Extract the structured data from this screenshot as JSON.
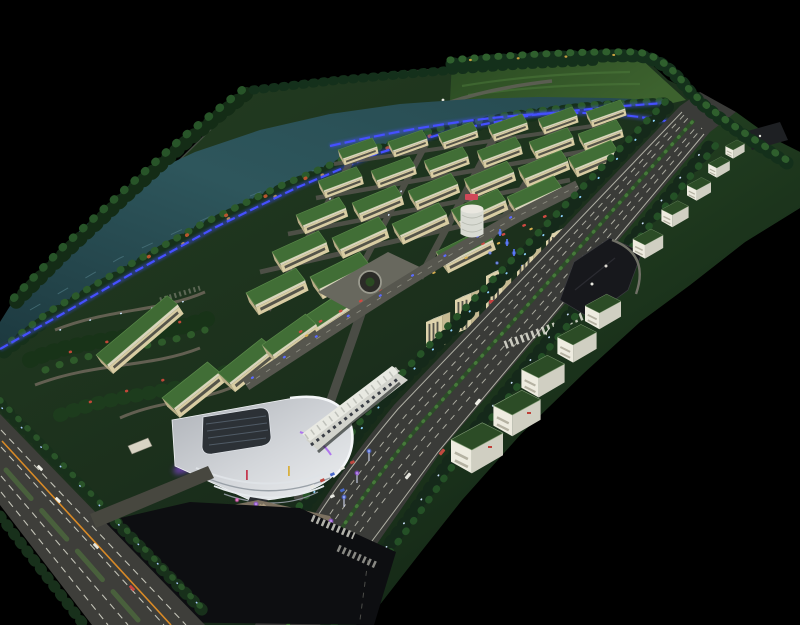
{
  "meta": {
    "type": "photograph",
    "subject": "Illuminated architectural scale model of an industrial park district, elevated oblique view on a black backdrop",
    "canvas": {
      "width": 800,
      "height": 625
    },
    "visible_text": []
  },
  "palette": {
    "background": "#000000",
    "site_green": "#1d331e",
    "lawn_green": "#3d622e",
    "water_teal": "#2e565c",
    "foliage_dark": "#15291a",
    "foliage_light": "#2c5a2b",
    "roof_green": "#416e36",
    "wall_cream": "#d8cca2",
    "tower_cream": "#ded3ac",
    "slab_white": "#e9e7dc",
    "asphalt": "#3a3b38",
    "asphalt_dark": "#0d0e11",
    "road_internal": "#54544c",
    "lane_dash": "#dadacb",
    "led_blue": "#4550ff",
    "accent_purple": "#a55cf0",
    "glow_pink": "#ff5fd0",
    "plaza_tan": "#7c7160",
    "centerline_orange": "#d98a26",
    "sign_red": "#c84040",
    "sign_pink": "#d04858",
    "cube_wall": "#eeece0",
    "cube_roof": "#2c4c26",
    "boat_white": "#e9e9e2"
  },
  "scene": {
    "board": {
      "label": "model board",
      "description": "rectangular site in two-point perspective, long axis receding to the upper right"
    },
    "river": {
      "label": "tree-lined canal with blue LED bank lighting",
      "boats": 6
    },
    "lawn": {
      "label": "open lawn field with perimeter tree row"
    },
    "warehouse_district": {
      "label": "grid of cream warehouses with green roofs",
      "blocks": 31,
      "rows": 7
    },
    "central_plaza": {
      "label": "paved roundabout plaza inside the grid"
    },
    "office_row": {
      "label": "cream mid-rise office slabs along central avenue",
      "towers": 6,
      "drum_tower": 1
    },
    "highway": {
      "label": "multi-lane divided boulevard with planted median",
      "vehicles": 7
    },
    "parking_lot": {
      "label": "dark parking pocket with loop curb"
    },
    "cube_row": {
      "label": "white factory cubes with dark green roofs along the frontage strip",
      "count": 10
    },
    "exhibition_center": {
      "label": "curved white exhibition hall with rooftop light-well and purple accent lighting"
    },
    "entry_plaza": {
      "label": "fan-shaped entry plaza with illuminated pylons and banners",
      "light_poles": 12,
      "stalls": 7
    },
    "intersection": {
      "label": "dark asphalt intersection with crosswalks"
    },
    "west_boulevard": {
      "label": "tree-lined boulevard with orange centerline",
      "vehicles": 4
    },
    "park": {
      "label": "landscaped park with winding paths and flower patches"
    }
  }
}
